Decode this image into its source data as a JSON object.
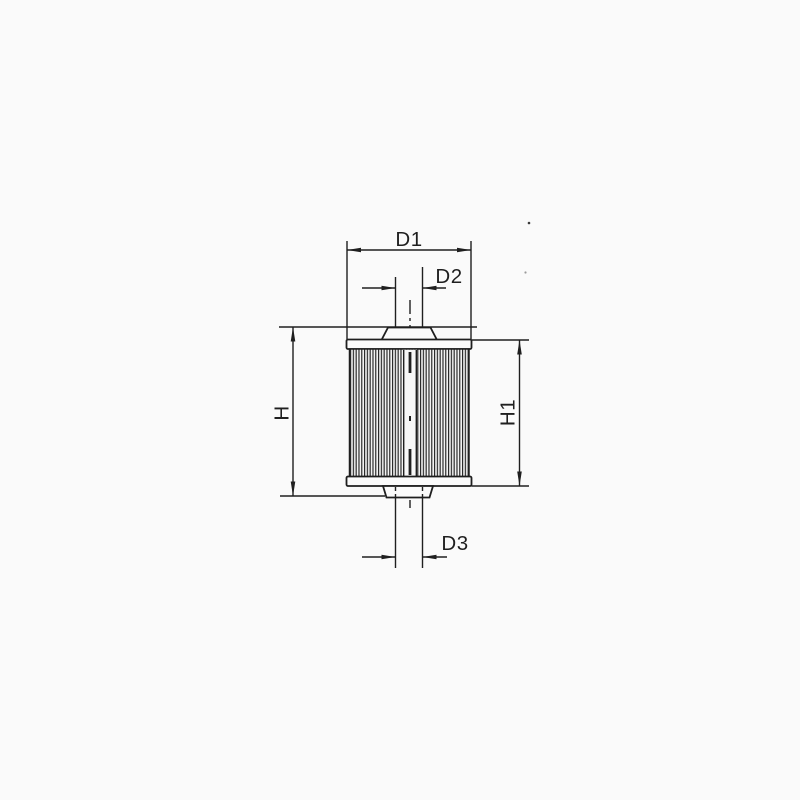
{
  "figure": {
    "kind": "technical-drawing",
    "subject": "cylindrical filter element with dimension callouts",
    "background_color": "#fafafa",
    "line_color": "#1f1f1f"
  },
  "dimension_labels": {
    "d1": "D1",
    "d2": "D2",
    "d3": "D3",
    "h": "H",
    "h1": "H1"
  }
}
